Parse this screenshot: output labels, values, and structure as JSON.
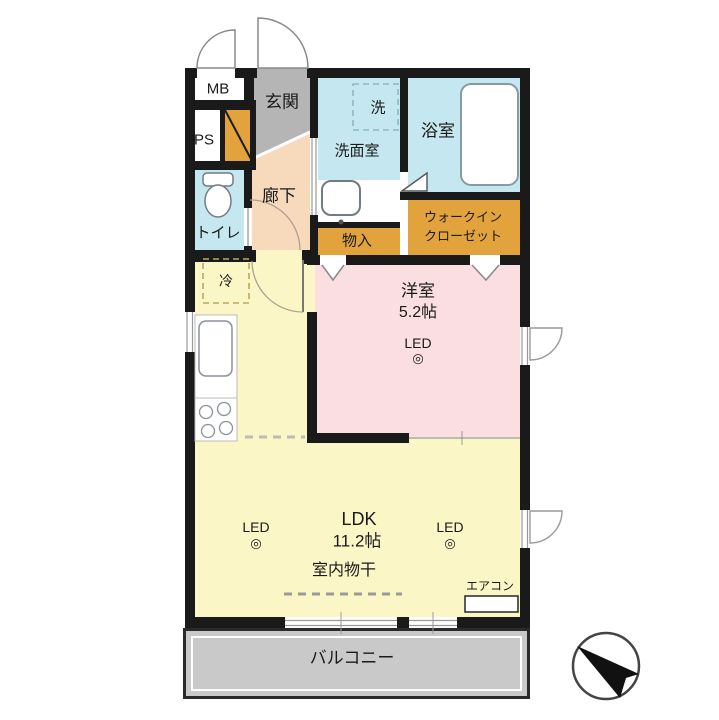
{
  "rooms": {
    "mb": "MB",
    "ps": "PS",
    "entrance": "玄関",
    "hallway": "廊下",
    "toilet": "トイレ",
    "washroom": "洗面室",
    "washer": "洗",
    "bathroom": "浴室",
    "storage": "物入",
    "wic_line1": "ウォークイン",
    "wic_line2": "クローゼット",
    "bedroom": "洋室",
    "bedroom_size": "5.2帖",
    "ldk": "LDK",
    "ldk_size": "11.2帖",
    "indoor_drying": "室内物干",
    "aircon": "エアコン",
    "balcony": "バルコニー",
    "fridge": "冷"
  },
  "icons": {
    "led_label": "LED",
    "led_mark": "◎"
  },
  "colors": {
    "wall": "#1a1a1a",
    "water_rooms": "#c5e8f0",
    "storage": "#e3a33c",
    "entrance": "#b5b5b5",
    "hallway": "#f7d9bc",
    "bedroom": "#fadee1",
    "living": "#fbf6c6",
    "balcony": "#c9c9c9"
  }
}
